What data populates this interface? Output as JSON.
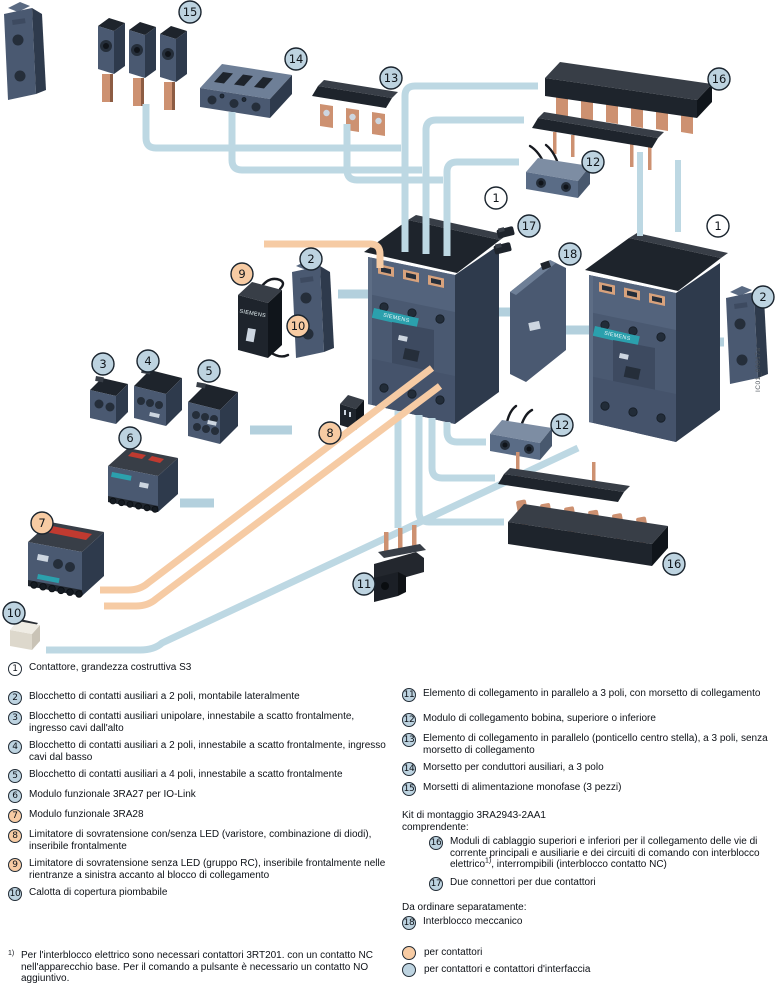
{
  "diagram": {
    "watermark": "IC01_00017a",
    "colors": {
      "callout_blue": "#bdd3e0",
      "callout_orange": "#f7cba3",
      "line_blue": "#bdd8e3",
      "line_orange": "#f6cba4",
      "body_blue_gray": "#4a5971",
      "copper": "#cd9171",
      "siemens_teal": "#2ba0ad"
    },
    "brand": "SIEMENS",
    "callouts": {
      "c15": {
        "n": "15",
        "color": "blue"
      },
      "c14": {
        "n": "14",
        "color": "blue"
      },
      "c13": {
        "n": "13",
        "color": "blue"
      },
      "c16t": {
        "n": "16",
        "color": "blue"
      },
      "c12t": {
        "n": "12",
        "color": "blue"
      },
      "c1l": {
        "n": "1",
        "color": "white"
      },
      "c17": {
        "n": "17",
        "color": "blue"
      },
      "c1r": {
        "n": "1",
        "color": "white"
      },
      "c18": {
        "n": "18",
        "color": "blue"
      },
      "c2l": {
        "n": "2",
        "color": "blue"
      },
      "c9": {
        "n": "9",
        "color": "orange"
      },
      "c2r": {
        "n": "2",
        "color": "blue"
      },
      "c10a": {
        "n": "10",
        "color": "orange"
      },
      "c3": {
        "n": "3",
        "color": "blue"
      },
      "c4": {
        "n": "4",
        "color": "blue"
      },
      "c5": {
        "n": "5",
        "color": "blue"
      },
      "c8": {
        "n": "8",
        "color": "orange"
      },
      "c6": {
        "n": "6",
        "color": "blue"
      },
      "c12b": {
        "n": "12",
        "color": "blue"
      },
      "c7": {
        "n": "7",
        "color": "orange"
      },
      "c16b": {
        "n": "16",
        "color": "blue"
      },
      "c11": {
        "n": "11",
        "color": "blue"
      },
      "c10b": {
        "n": "10",
        "color": "blue"
      }
    }
  },
  "legend": {
    "left": [
      {
        "num": "1",
        "color": "white",
        "text": "Contattore, grandezza costruttiva S3"
      },
      {
        "num": "2",
        "color": "blue",
        "text": "Blocchetto di contatti ausiliari a 2 poli, montabile lateralmente"
      },
      {
        "num": "3",
        "color": "blue",
        "text": "Blocchetto di contatti ausiliari unipolare, innestabile a scatto frontalmente, ingresso cavi dall'alto"
      },
      {
        "num": "4",
        "color": "blue",
        "text": "Blocchetto di contatti ausiliari a 2 poli, innestabile a scatto frontalmente, ingresso cavi dal basso"
      },
      {
        "num": "5",
        "color": "blue",
        "text": "Blocchetto di contatti ausiliari a 4 poli, innestabile a scatto frontalmente"
      },
      {
        "num": "6",
        "color": "blue",
        "text": "Modulo funzionale 3RA27 per IO-Link"
      },
      {
        "num": "7",
        "color": "orange",
        "text": "Modulo funzionale 3RA28"
      },
      {
        "num": "8",
        "color": "orange",
        "text": "Limitatore di sovratensione con/senza LED (varistore, combinazione di diodi), inseribile frontalmente"
      },
      {
        "num": "9",
        "color": "orange",
        "text": "Limitatore di sovratensione senza LED (gruppo RC), inseribile frontalmente nelle rientranze a sinistra accanto al blocco di collegamento"
      },
      {
        "num": "10",
        "color": "blue",
        "text": "Calotta di copertura piombabile"
      }
    ],
    "right": [
      {
        "num": "11",
        "color": "blue",
        "text": "Elemento di collegamento in parallelo a 3 poli, con morsetto di collegamento"
      },
      {
        "num": "12",
        "color": "blue",
        "text": "Modulo di collegamento bobina, superiore o inferiore"
      },
      {
        "num": "13",
        "color": "blue",
        "text": "Elemento di collegamento in parallelo (ponticello centro stella), a 3 poli, senza morsetto di collegamento"
      },
      {
        "num": "14",
        "color": "blue",
        "text": "Morsetto per conduttori ausiliari, a 3 polo"
      },
      {
        "num": "15",
        "color": "blue",
        "text": "Morsetti di alimentazione monofase (3 pezzi)"
      }
    ],
    "kit_title": "Kit di montaggio 3RA2943-2AA1",
    "kit_subtitle": "comprendente:",
    "kit_items": {
      "i16": {
        "num": "16",
        "color": "blue",
        "text_before": "Moduli di cablaggio superiori e inferiori per il collegamento delle vie di corrente principali e ausiliarie e dei circuiti di comando con interblocco elettrico",
        "sup": "1)",
        "text_after": ", interrompibili (interblocco contatto NC)"
      },
      "i17": {
        "num": "17",
        "color": "blue",
        "text": "Due connettori per due contattori"
      }
    },
    "separate_title": "Da ordinare separatamente:",
    "separate_items": [
      {
        "num": "18",
        "color": "blue",
        "text": "Interblocco meccanico"
      }
    ],
    "key": [
      {
        "color": "orange",
        "text": "per contattori"
      },
      {
        "color": "blue",
        "text": "per contattori e contattori d'interfaccia"
      }
    ],
    "footnote": {
      "marker": "1)",
      "text": "Per l'interblocco elettrico sono necessari contattori 3RT201. con un contatto NC nell'apparecchio base. Per il comando a pulsante è necessario un contatto NO aggiuntivo."
    }
  }
}
